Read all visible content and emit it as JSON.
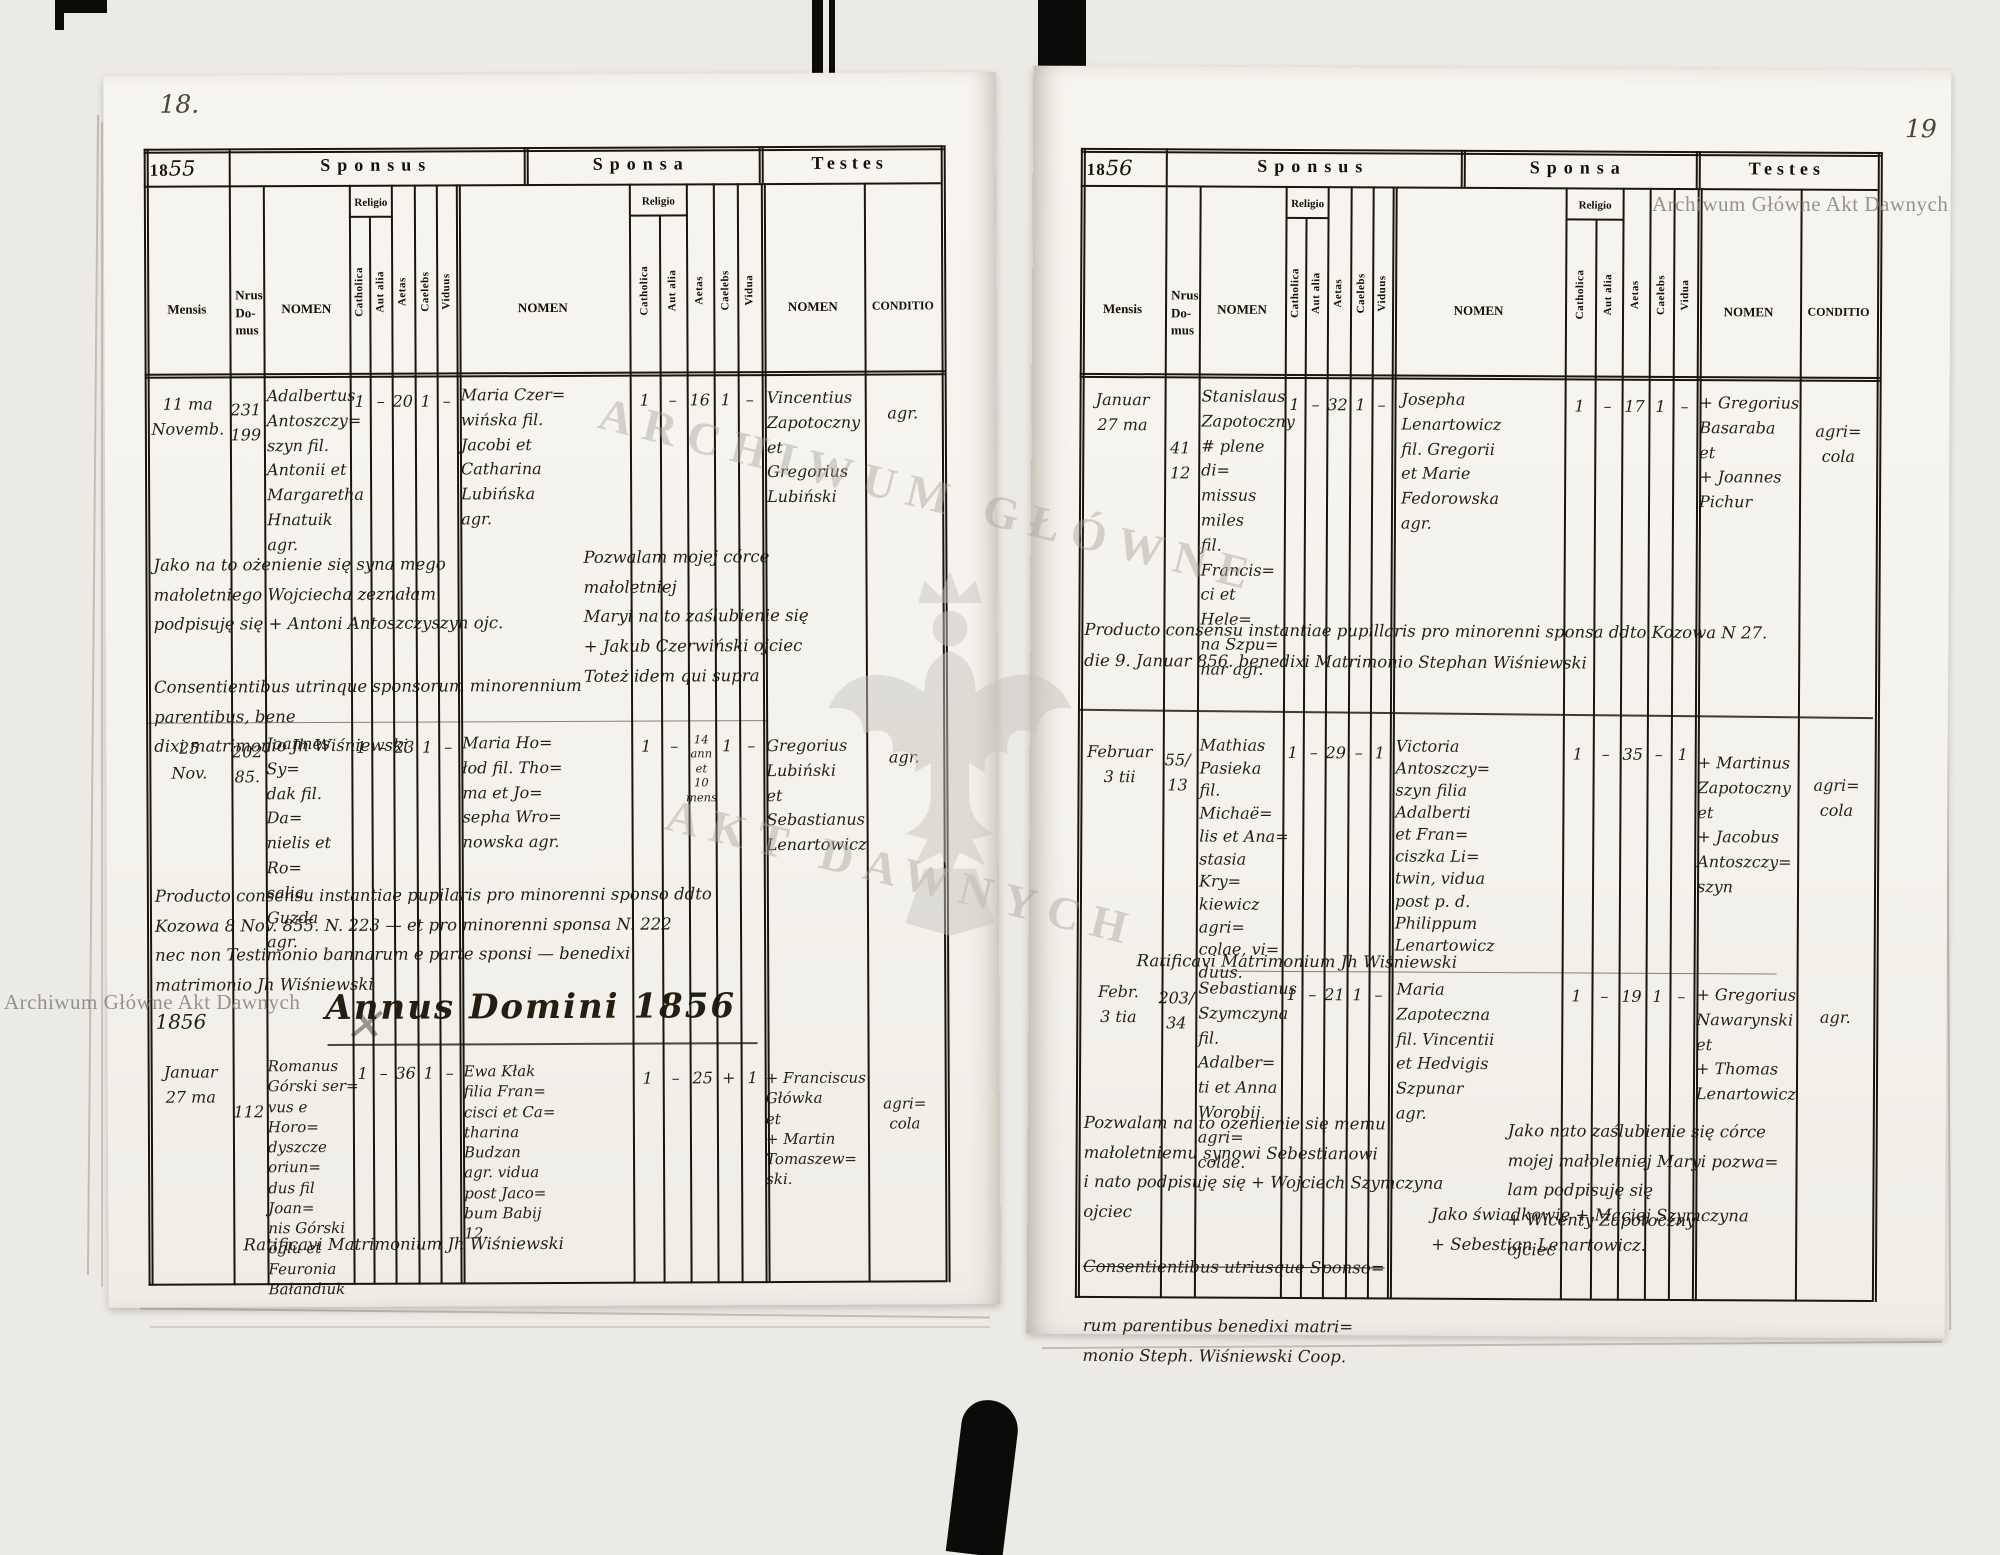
{
  "watermark": {
    "text": "Archiwum Główne Akt Dawnych",
    "big1": "ARCHIWUM GŁÓWNE",
    "big2": "AKT DAWNYCH"
  },
  "labels": {
    "year_prefix": "18",
    "sponsus": "Sponsus",
    "sponsa": "Sponsa",
    "testes": "Testes",
    "mensis": "Mensis",
    "domus": "Nrus\nDo-\nmus",
    "nomen": "NOMEN",
    "religio": "Religio",
    "catholica": "Catholica",
    "aut_alia": "Aut alia",
    "aetas": "Aetas",
    "caelebs": "Caelebs",
    "viduus": "Viduus",
    "vidua": "Vidua",
    "conditio": "CONDITIO"
  },
  "left": {
    "page_no": "18.",
    "year_hand": "55",
    "e1": {
      "m": "11 ma\nNovemb.",
      "d": "231\n199",
      "sp": "Adalbertus\nAntoszczy=\nszyn fil.\nAntonii et\nMargaretha\nHnatuik\nagr.",
      "c1": "1",
      "a1": "–",
      "ae1": "20",
      "cb1": "1",
      "v1": "–",
      "sa": "Maria Czer=\nwińska fil.\nJacobi et\nCatharina\nLubińska\nagr.",
      "c2": "1",
      "a2": "–",
      "ae2": "16",
      "cb2": "1",
      "v2": "–",
      "t": "Vincentius\nZapotoczny\net\nGregorius\nLubiński",
      "cond": "agr."
    },
    "n1l": "Jako na to ożenienie się syna mego\nmałoletniego Wojciecha zeznałam\npodpisuję się + Antoni Antoszczyszyn ojc.",
    "n1r": "Pozwalam mojej córce małoletniej\nMaryi na to zaślubienie się\n+ Jakub Czerwiński ojciec\nToteż idem qui supra",
    "n2": "Consentientibus utrinque sponsorum minorennium parentibus, bene\ndixi matrimonio    Jh Wiśniewski",
    "e2": {
      "m": "25\nNov.",
      "d": "202\n85.",
      "sp": "Joannes Sy=\ndak fil. Da=\nnielis et Ro=\nsalia Guzda\nagr.",
      "c1": "1",
      "a1": "–",
      "ae1": "23",
      "cb1": "1",
      "v1": "–",
      "sa": "Maria Ho=\nłod fil. Tho=\nma et Jo=\nsepha Wro=\nnowska agr.",
      "c2": "1",
      "a2": "–",
      "ae2": "14\nann\net\n10\nmens",
      "cb2": "1",
      "v2": "–",
      "t": "Gregorius\nLubiński\net\nSebastianus\nLenartowicz",
      "cond": "agr."
    },
    "n3": "Producto consensu instantiae pupilaris pro minorenni sponso ddto\nKozowa 8 Nov. 855.  N. 223 — et pro minorenni sponsa N. 222\nnec non Testimonio bannarum e parte sponsi — benedixi\nmatrimonio    Jh Wiśniewski",
    "year_side": "1856",
    "xmark": "✕",
    "annus_heading": "Annus Domini 1856",
    "e3": {
      "m": "Januar\n27 ma",
      "d": "112",
      "sp": "Romanus\nGórski ser=\nvus e Horo=\ndyszcze oriun=\ndus fil Joan=\nnis Górski\nóglu et\nFeuronia\nBałandiuk",
      "c1": "1",
      "a1": "–",
      "ae1": "36",
      "cb1": "1",
      "v1": "–",
      "sa": "Ewa Kłak\nfilia Fran=\ncisci et Ca=\ntharina\nBudzan\nagr. vidua\npost Jaco=\nbum Babij\n12.",
      "c2": "1",
      "a2": "–",
      "ae2": "25",
      "cb2": "+",
      "v2": "1",
      "t": "+ Franciscus\nGłówka\net\n+ Martin\nTomaszew=\nski.",
      "cond": "agri=\ncola"
    },
    "n4": "Ratificavi Matrimonium    Jh Wiśniewski"
  },
  "right": {
    "page_no": "19",
    "year_hand": "56",
    "e1": {
      "m": "Januar\n27 ma",
      "d": "41\n12",
      "sp": "Stanislaus\nZapotoczny\n# plene di=\nmissus miles\nfil. Francis=\nci et Hele=\nna Szpu=\nnar agr.",
      "c1": "1",
      "a1": "–",
      "ae1": "32",
      "cb1": "1",
      "v1": "–",
      "sa": "Josepha\nLenartowicz\nfil. Gregorii\net Marie\nFedorowska\nagr.",
      "c2": "1",
      "a2": "–",
      "ae2": "17",
      "cb2": "1",
      "v2": "–",
      "t": "+ Gregorius\nBasaraba\net\n+ Joannes\nPichur",
      "cond": "agri=\ncola"
    },
    "n1": "Producto consensu instantiae pupillaris pro minorenni sponsa ddto Kozowa N 27.\ndie 9. Januar 856.   benedixi   Matrimonio   Stephan Wiśniewski",
    "e2": {
      "m": "Februar\n3 tii",
      "d": "55/\n13",
      "sp": "Mathias\nPasieka\nfil. Michaë=\nlis et Ana=\nstasia Kry=\nkiewicz agri=\ncolae, vi=\nduus.",
      "c1": "1",
      "a1": "–",
      "ae1": "29",
      "cb1": "–",
      "v1": "1",
      "sa": "Victoria\nAntoszczy=\nszyn filia\nAdalberti\net Fran=\nciszka Li=\ntwin, vidua\npost p. d.\nPhilippum\nLenartowicz",
      "c2": "1",
      "a2": "–",
      "ae2": "35",
      "cb2": "–",
      "v2": "1",
      "t": "+ Martinus\nZapotoczny\net\n+ Jacobus\nAntoszczy=\nszyn",
      "cond": "agri=\ncola"
    },
    "n2": "Ratificavi Matrimonium    Jh Wiśniewski",
    "e3": {
      "m": "Febr.\n3 tia",
      "d": "203/\n34",
      "sp": "Sebastianus\nSzymczyna\nfil. Adalber=\nti et Anna\nWorobij agri=\ncolae.",
      "c1": "1",
      "a1": "–",
      "ae1": "21",
      "cb1": "1",
      "v1": "–",
      "sa": "Maria\nZapoteczna\nfil. Vincentii\net Hedvigis\nSzpunar\nagr.",
      "c2": "1",
      "a2": "–",
      "ae2": "19",
      "cb2": "1",
      "v2": "–",
      "t": "+ Gregorius\nNawarynski\net\n+ Thomas\nLenartowicz",
      "cond": "agr."
    },
    "n3l": "Pozwalam na to ożenienie się memu\nmałoletniemu synowi Sebestianowi\ni nato podpisuję się + Wojciech Szymczyna\nojciec",
    "n3r": "Jako nato zaślubienie się córce\nmojej małoletniej Maryi pozwa=\nlam podpisuję się\n+ Wicenty Zapotoczny\nojciec",
    "witnesses": "Jako świadkowie + Maciej Szymczyna\n+ Sebestian Lenartowicz.",
    "n5_struck": "Consentientibus utriusque Sponso=",
    "n5_rest": "rum parentibus benedixi matri=\nmonio   Steph. Wiśniewski   Coop."
  }
}
